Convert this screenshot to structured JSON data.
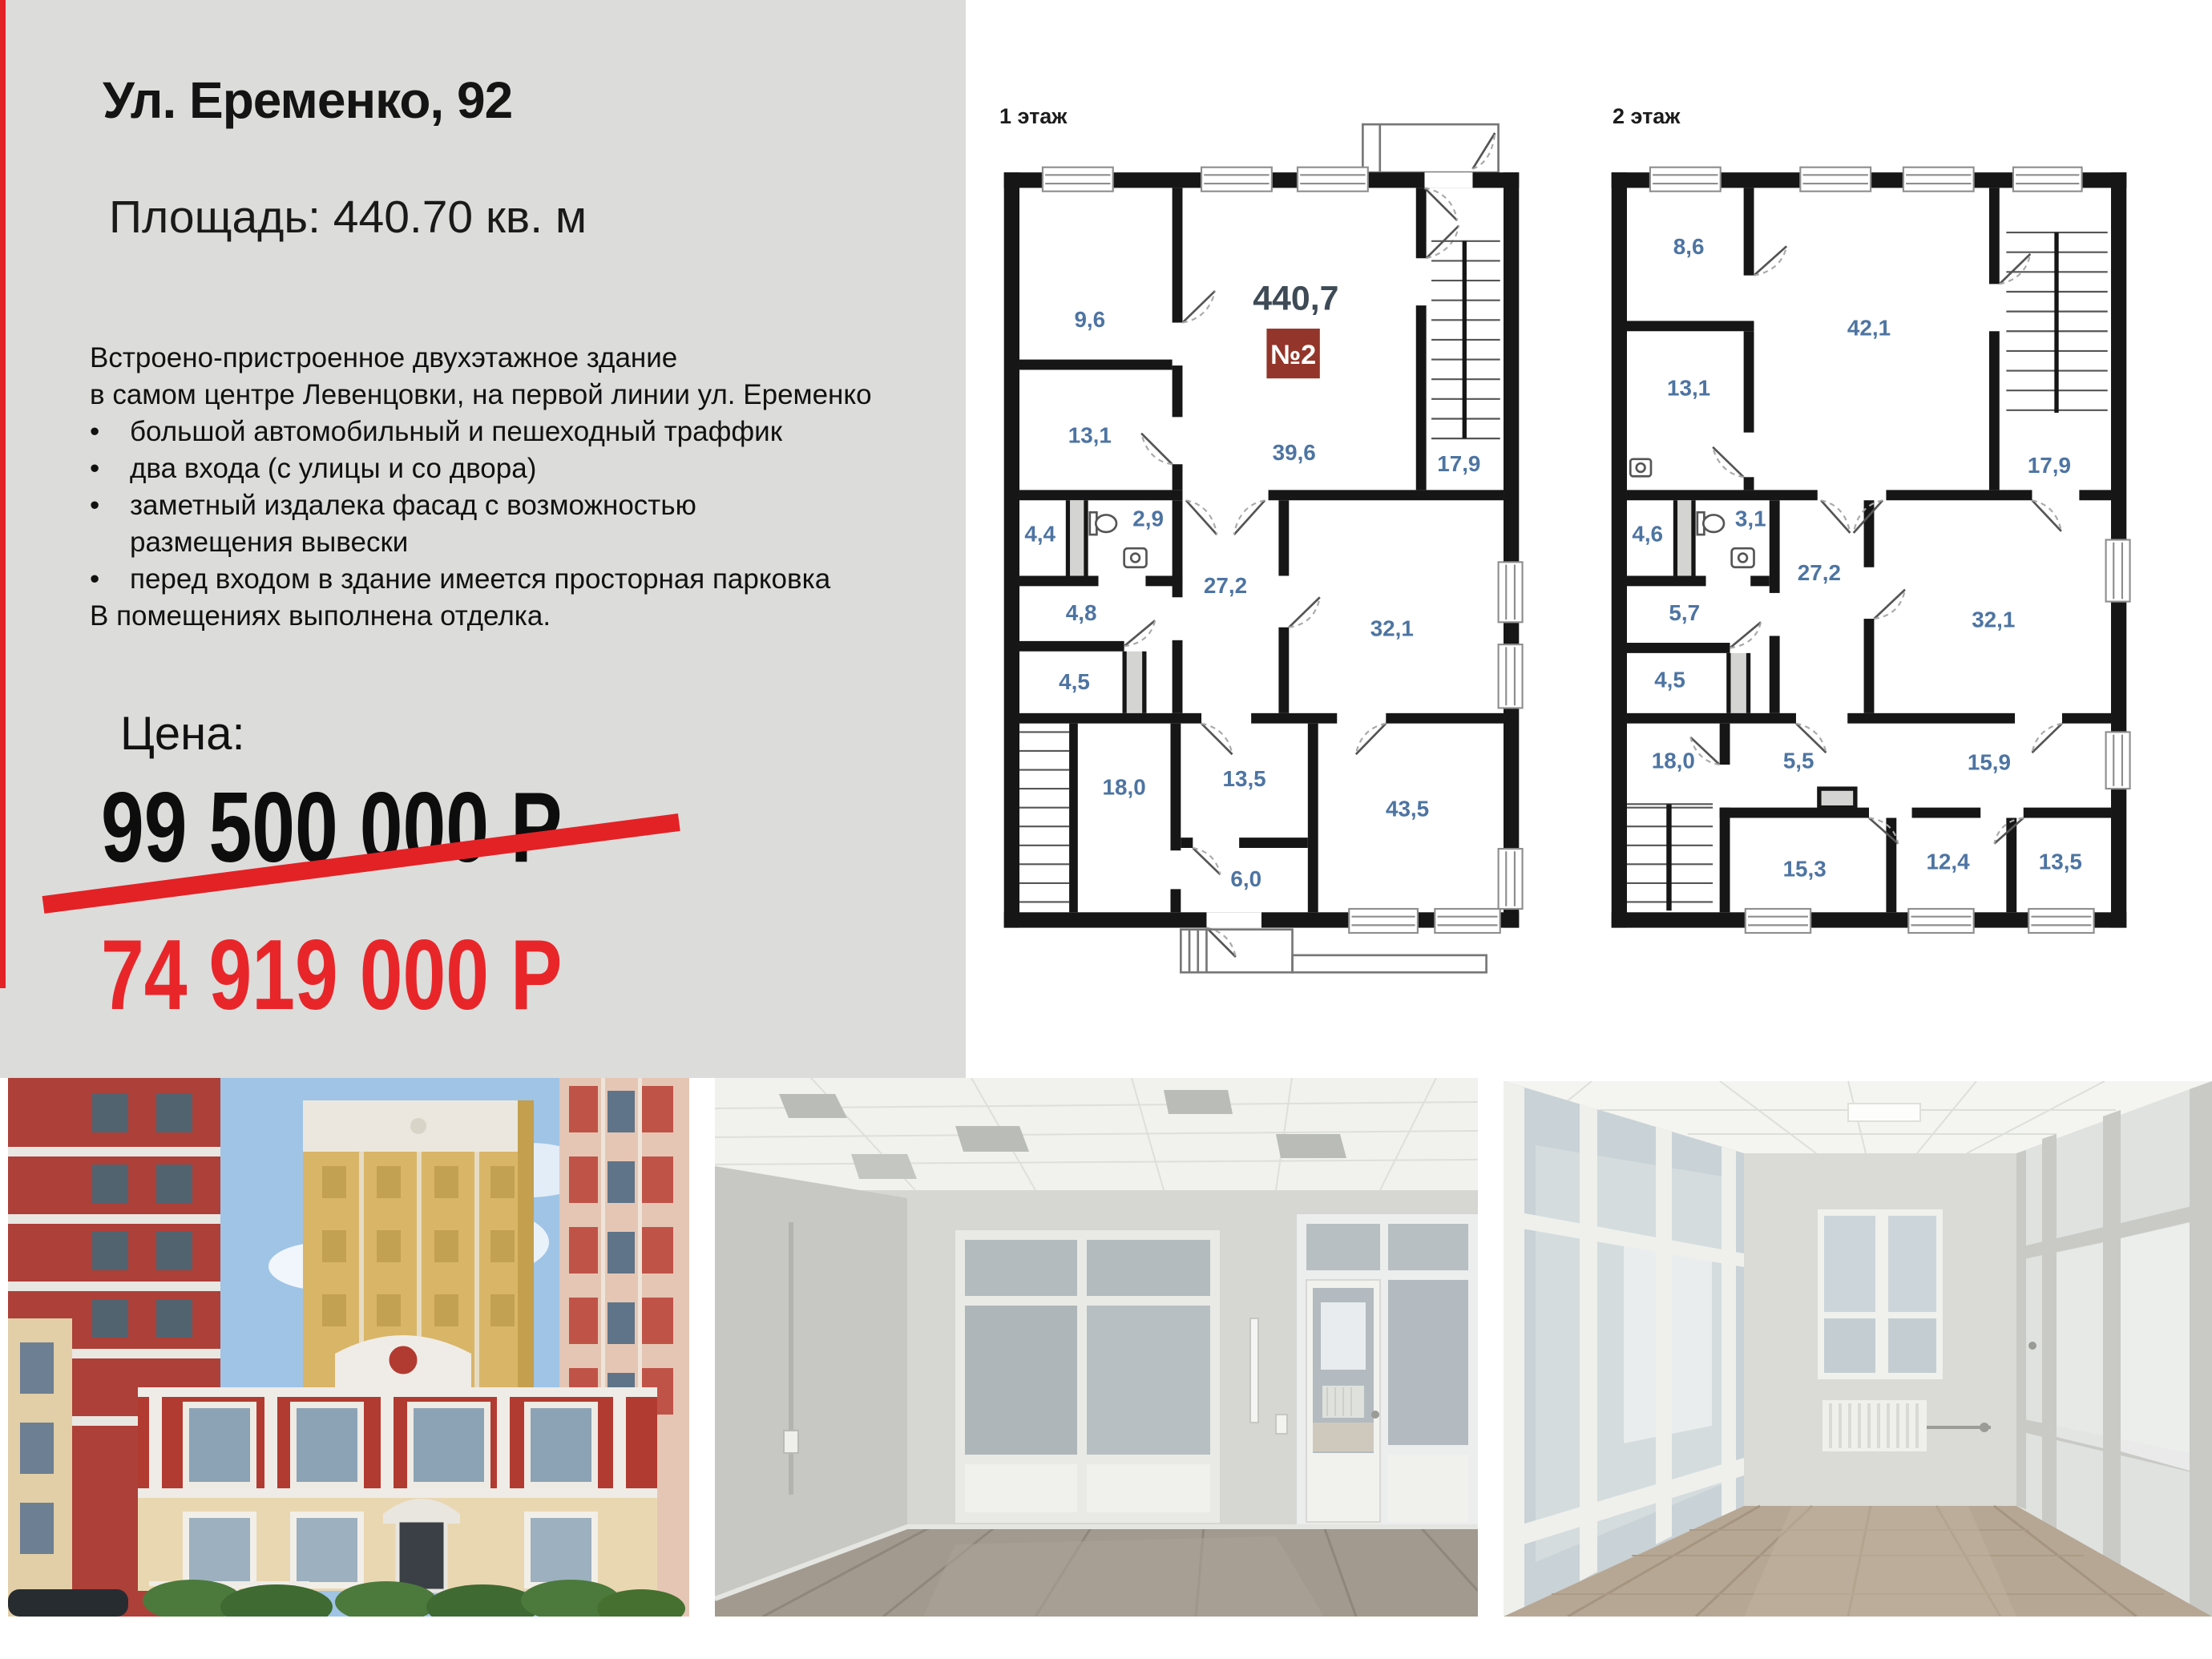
{
  "listing": {
    "title": "Ул. Еременко, 92",
    "area_line": "Площадь: 440.70 кв. м",
    "bullet_char": "•",
    "description_rows": [
      {
        "text": "Встроено-пристроенное двухэтажное здание"
      },
      {
        "text": "в самом центре Левенцовки, на первой линии ул. Еременко"
      },
      {
        "text": "большой автомобильный и пешеходный траффик"
      },
      {
        "text": "два входа (с улицы и со двора)"
      },
      {
        "text": "заметный издалека фасад с возможностью"
      },
      {
        "text": "размещения вывески"
      },
      {
        "text": "перед входом в здание имеется просторная парковка"
      },
      {
        "text": "В помещениях выполнена отделка."
      }
    ],
    "price_label": "Цена:",
    "old_price": "99 500 000 Р",
    "new_price": "74 919 000 Р"
  },
  "plans": {
    "floor1": {
      "label": "1 этаж",
      "total_area": "440,7",
      "unit": "№2",
      "rooms": [
        "9,6",
        "13,1",
        "39,6",
        "17,9",
        "4,4",
        "2,9",
        "27,2",
        "32,1",
        "4,8",
        "4,5",
        "18,0",
        "13,5",
        "6,0",
        "43,5"
      ]
    },
    "floor2": {
      "label": "2 этаж",
      "rooms": [
        "8,6",
        "42,1",
        "13,1",
        "17,9",
        "4,6",
        "3,1",
        "27,2",
        "32,1",
        "5,7",
        "4,5",
        "18,0",
        "5,5",
        "15,9",
        "15,3",
        "12,4",
        "13,5"
      ]
    }
  },
  "photos": [
    {
      "alt": "фасад здания"
    },
    {
      "alt": "офисное помещение"
    },
    {
      "alt": "коридор с перегородками"
    }
  ],
  "colors": {
    "accent": "#e32226",
    "price": "#e8262a",
    "badge": "#93352a",
    "room_label": "#4d74a2"
  }
}
